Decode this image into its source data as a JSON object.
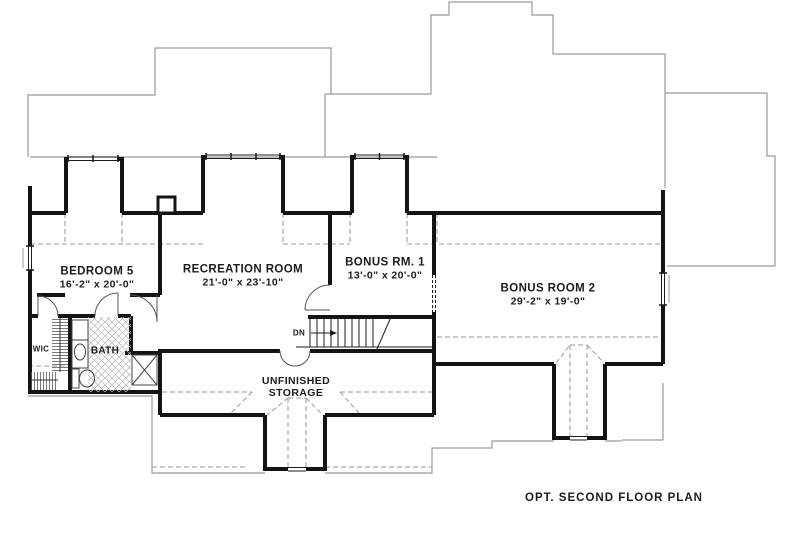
{
  "caption": "OPT. SECOND FLOOR PLAN",
  "rooms": [
    {
      "name": "BEDROOM 5",
      "dims": "16'-2\" x 20'-0\""
    },
    {
      "name": "RECREATION ROOM",
      "dims": "21'-0\" x 23'-10\""
    },
    {
      "name": "BONUS RM. 1",
      "dims": "13'-0\" x 20'-0\""
    },
    {
      "name": "BONUS ROOM 2",
      "dims": "29'-2\" x 19'-0\""
    },
    {
      "name": "UNFINISHED",
      "dims": "STORAGE"
    }
  ],
  "labels": {
    "wic": "WIC",
    "bath": "BATH",
    "down": "DN"
  },
  "colors": {
    "wall": "#141414",
    "roofline": "#9a9a9a",
    "dashed": "#9a9a9a",
    "fixture": "#444444",
    "tile": "#b9b9b9",
    "text": "#1c1c1c",
    "background": "#ffffff"
  }
}
